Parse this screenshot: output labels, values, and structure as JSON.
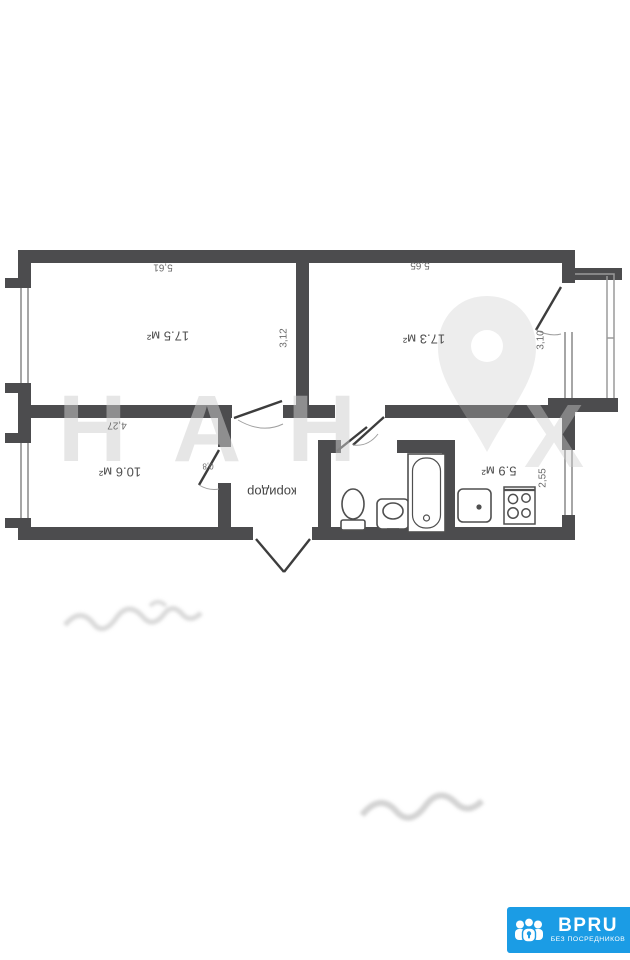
{
  "plan": {
    "corridor_label": "коридор",
    "rooms": {
      "room1": {
        "area": "17.5 м²",
        "width": "5,61",
        "depth": "3,12"
      },
      "room2": {
        "area": "17.3 м²",
        "width": "5,65",
        "depth": "3,10"
      },
      "room3": {
        "area": "10.6 м²",
        "width": "4,27",
        "door_width": "0,8"
      },
      "kitchen": {
        "area": "5.9 м²",
        "depth": "2,55"
      }
    },
    "colors": {
      "wall": "#4c4c4e",
      "thin_line": "#8f8f8f"
    }
  },
  "watermark": {
    "letters": "НАН",
    "letter_right": "Х"
  },
  "logo": {
    "brand": "BPRU",
    "tagline": "БЕЗ ПОСРЕДНИКОВ",
    "accent_color": "#1b9ce5",
    "icon": "people-lock-icon"
  }
}
